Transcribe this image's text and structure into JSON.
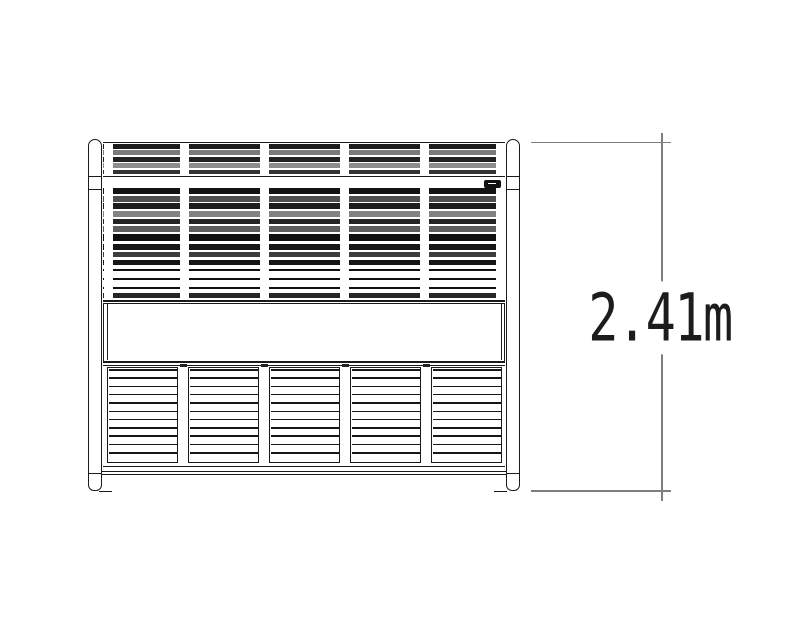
{
  "dimension": {
    "label": "2.41m"
  },
  "colors": {
    "ink": "#1a1a1a",
    "dim_line": "#7e7e7e",
    "text": "#1c1c1c",
    "background": "#ffffff",
    "plate": "#111111",
    "plate_mark": "#ffffff"
  },
  "structure": {
    "bays": 5,
    "tick_columns_x": [
      103.5,
      179.5,
      259.5,
      339.5,
      419.5,
      495.8
    ],
    "louvre_groups": [
      {
        "name": "top-slat-group-a",
        "start": 144.0,
        "pitch": 6.4,
        "count": 5,
        "h": 4.9,
        "shades": [
          "#1b1b1b",
          "#7a7a7a",
          "#222222",
          "#8d8d8d",
          "#333333"
        ]
      },
      {
        "name": "top-slat-group-b",
        "start": 188.2,
        "pitch": 7.6,
        "count": 6,
        "h": 5.8,
        "shades": [
          "#141414",
          "#4f4f4f",
          "#1d1d1d",
          "#828282",
          "#232323",
          "#5d5d5d"
        ]
      },
      {
        "name": "solid-band",
        "start": 233.8,
        "pitch": 8.0,
        "count": 1,
        "h": 7.6,
        "shades": [
          "#101010"
        ]
      },
      {
        "name": "top-slat-group-c",
        "start": 244.0,
        "pitch": 7.9,
        "count": 3,
        "h": 5.6,
        "shades": [
          "#161616",
          "#3d3d3d",
          "#161616"
        ]
      },
      {
        "name": "open-louvre-lines",
        "start": 268.8,
        "pitch": 9.1,
        "count": 3,
        "h": 2.0,
        "shades": [
          "#111111"
        ]
      },
      {
        "name": "base-slat",
        "start": 293.0,
        "pitch": 6.0,
        "count": 1,
        "h": 5.0,
        "shades": [
          "#262626"
        ]
      }
    ],
    "bottom_panels": {
      "count": 5,
      "lefts": [
        107,
        188,
        269,
        350,
        431
      ],
      "width": 71,
      "slat_lines": 11,
      "separator_caps_x": [
        179.5,
        260.5,
        341.5,
        422.5
      ]
    },
    "posts": 2,
    "brand_plate": true
  }
}
